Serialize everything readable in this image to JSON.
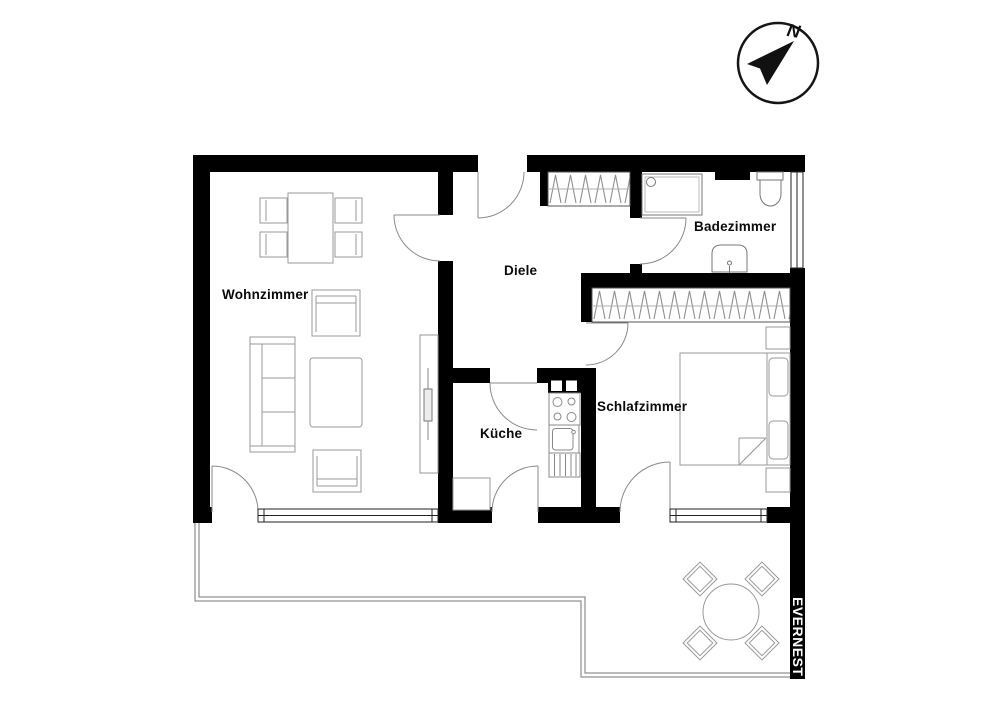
{
  "floorplan": {
    "rooms": {
      "wohnzimmer": {
        "label": "Wohnzimmer"
      },
      "diele": {
        "label": "Diele"
      },
      "kueche": {
        "label": "Küche"
      },
      "badezimmer": {
        "label": "Badezimmer"
      },
      "schlafzimmer": {
        "label": "Schlafzimmer"
      }
    },
    "brand": {
      "name": "EVERNEST"
    },
    "compass": {
      "label": "N"
    },
    "features": {
      "doors": [
        "entrance-door",
        "wohnzimmer-door",
        "kueche-door",
        "badezimmer-door",
        "schlafzimmer-door",
        "wohnzimmer-terrace-door",
        "kueche-terrace-door",
        "schlafzimmer-terrace-door"
      ],
      "windows": [
        "wohnzimmer-window",
        "schlafzimmer-window",
        "badezimmer-window"
      ],
      "furniture": [
        "dining-table",
        "dining-chairs",
        "sofa",
        "coffee-table",
        "armchairs",
        "tv-sideboard",
        "wardrobe",
        "hall-closet",
        "bed",
        "nightstands",
        "kitchen-stove",
        "kitchen-sink",
        "kitchen-drawers",
        "shower",
        "toilet",
        "bath-sink",
        "terrace-table",
        "terrace-chairs"
      ]
    },
    "colors": {
      "wall": "#000000",
      "furniture_line": "#999999",
      "door_line": "#8a8a8a",
      "window_line": "#222222",
      "background": "#ffffff",
      "brand_bar": "#000000",
      "brand_text": "#ffffff"
    }
  }
}
